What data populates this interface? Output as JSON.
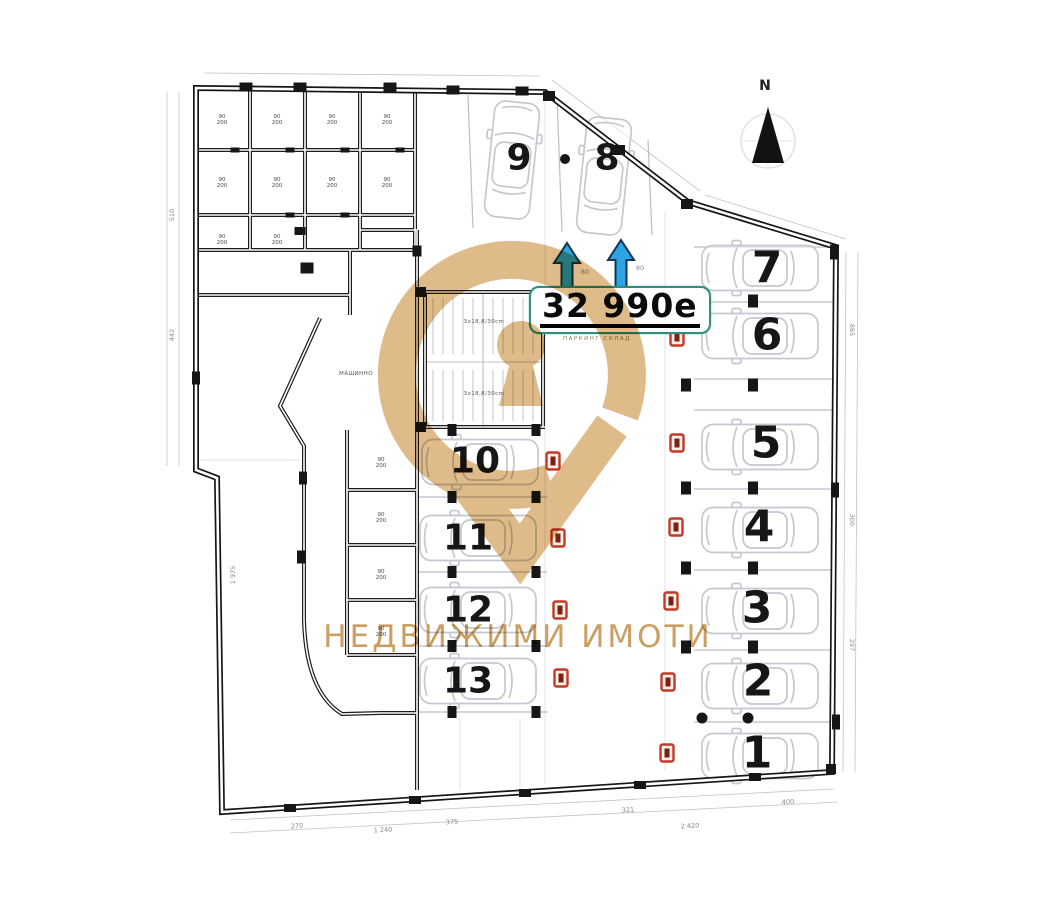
{
  "compass": {
    "label": "N"
  },
  "price_tag": {
    "value": "32 990e",
    "caption": "ПАРКИНГ СКЛАД"
  },
  "watermark": {
    "brand_text": "НЕДВИЖИМИ ИМОТИ"
  },
  "parking_spots": [
    "1",
    "2",
    "3",
    "4",
    "5",
    "6",
    "7",
    "8",
    "9",
    "10",
    "11",
    "12",
    "13"
  ],
  "labels": {
    "machine_room": "МАШИННО",
    "stair_note": "3x18,8/30cm",
    "storage_cell": "90\n200",
    "arrow_note": "80"
  },
  "dimensions": {
    "bottom": [
      "270",
      "1 240",
      "375",
      "321",
      "2 420",
      "400"
    ],
    "right": [
      "885",
      "300",
      "297"
    ],
    "left": [
      "510",
      "442",
      "1 975"
    ]
  },
  "colors": {
    "watermark_gold": "#d9ac70",
    "price_border": "#2f8f7a",
    "arrow_blue": "#2da4e4",
    "marker_red": "#c03a28"
  }
}
